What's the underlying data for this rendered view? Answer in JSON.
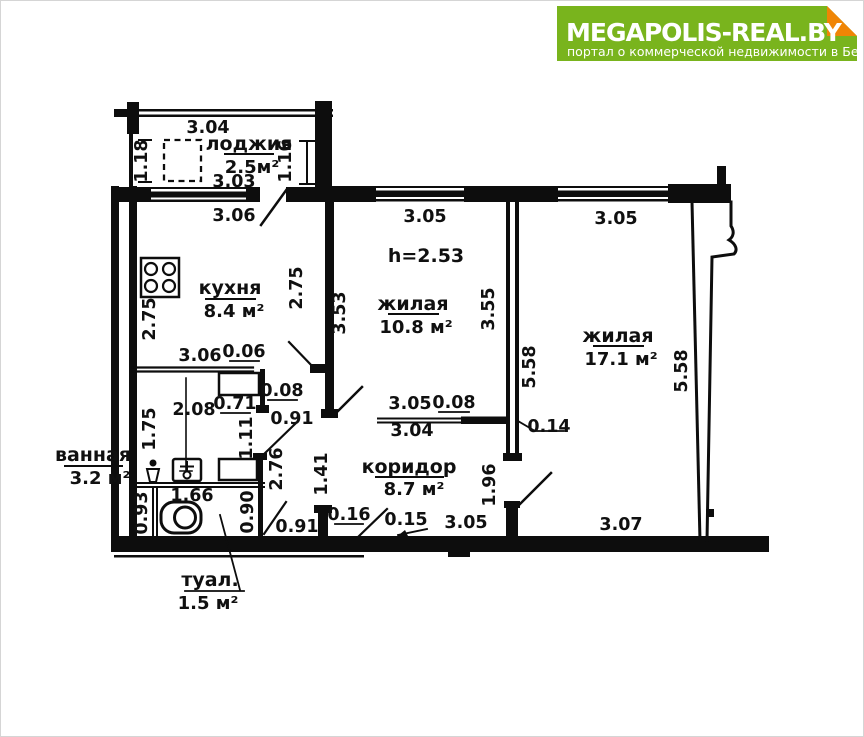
{
  "header": {
    "brand": "MEGAPOLIS-REAL.BY",
    "tagline": "портал о коммерческой недвижимости в Беларуси",
    "colors": {
      "green": "#79b41d",
      "orange": "#f08505"
    }
  },
  "plan": {
    "ceiling_height": "h=2.53",
    "rooms": {
      "lodzhia": {
        "name": "лоджия",
        "area": "2.5м²"
      },
      "kitchen": {
        "name": "кухня",
        "area": "8.4 м²"
      },
      "living1": {
        "name": "жилая",
        "area": "10.8 м²"
      },
      "living2": {
        "name": "жилая",
        "area": "17.1 м²"
      },
      "corridor": {
        "name": "коридор",
        "area": "8.7 м²"
      },
      "bathroom": {
        "name": "ванная",
        "area": "3.2 м²"
      },
      "toilet": {
        "name": "туал.",
        "area": "1.5 м²"
      }
    },
    "dims": {
      "balc_top": "3.04",
      "balc_left": "1.18",
      "balc_right": "1.16",
      "balc_bottom": "3.03",
      "kitchen_window": "3.06",
      "kitchen_left": "2.75",
      "kitchen_right": "2.75",
      "kitchen_bottom": "3.06",
      "kitchen_bottom_off": "0.06",
      "living1_top": "3.05",
      "living1_left": "3.53",
      "living1_right": "3.55",
      "living1_bottom": "3.05",
      "living1_bottom_off": "0.08",
      "living1_bottom2": "3.04",
      "living2_top": "3.05",
      "living2_left": "5.58",
      "living2_right": "5.58",
      "living2_wall_off": "0.14",
      "living2_bottom": "3.07",
      "hall_cab": "0.71",
      "hall_off": "0.08",
      "hall_door": "0.91",
      "bath_width": "2.08",
      "bath_left": "1.75",
      "bath_mid": "1.11",
      "bath_right": "2.76",
      "toilet_width": "1.66",
      "toilet_left": "0.93",
      "toilet_right": "0.90",
      "toilet_door": "0.91",
      "corr_left": "1.41",
      "corr_stub": "0.16",
      "corr_door_right": "1.96",
      "corr_bottom_off": "0.15",
      "corr_bottom": "3.05"
    }
  }
}
